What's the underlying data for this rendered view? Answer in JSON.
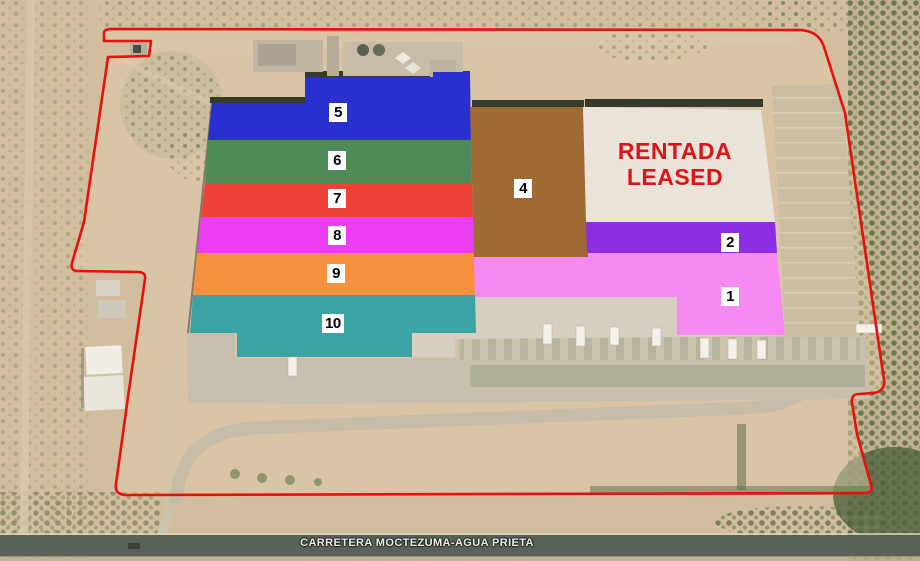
{
  "map": {
    "zones": {
      "z1": {
        "label": "1",
        "color": "#f689f2"
      },
      "z2": {
        "label": "2",
        "color": "#8c2fe2"
      },
      "z4": {
        "label": "4",
        "color": "#a06a35"
      },
      "z5": {
        "label": "5",
        "color": "#2a2fd0"
      },
      "z6": {
        "label": "6",
        "color": "#4f8a59"
      },
      "z7": {
        "label": "7",
        "color": "#ee4137"
      },
      "z8": {
        "label": "8",
        "color": "#ec3df2"
      },
      "z9": {
        "label": "9",
        "color": "#f6913d"
      },
      "z10": {
        "label": "10",
        "color": "#3ba3a3"
      }
    },
    "leased_area": {
      "line1": "RENTADA",
      "line2": "LEASED",
      "text_color": "#dc1419",
      "fill": "#e9e3da"
    },
    "road_label": "CARRETERA MOCTEZUMA-AGUA PRIETA",
    "boundary_color": "#e90f0b"
  }
}
